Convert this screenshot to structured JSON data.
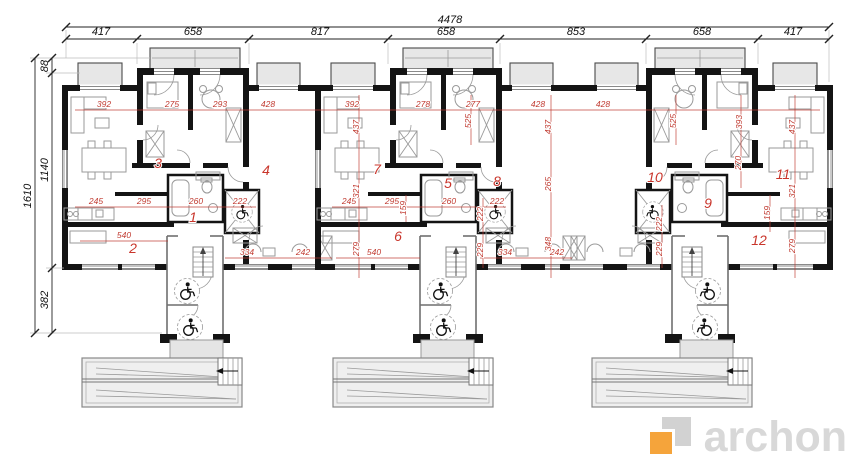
{
  "brand": {
    "name": "archon",
    "accent_color": "#F5A43B",
    "text_color": "#D8D8D8"
  },
  "colors": {
    "dimension_red": "#C03A30",
    "wall": "#141414",
    "fill_gray": "#E7E7E7"
  },
  "dimension_chains": {
    "top": {
      "total": "4478",
      "segments": [
        "417",
        "658",
        "817",
        "658",
        "853",
        "658",
        "417"
      ]
    },
    "left": {
      "total": "1610",
      "segments": [
        "88",
        "1140",
        "382"
      ]
    }
  },
  "unit_numbers": [
    "1",
    "2",
    "3",
    "4",
    "5",
    "6",
    "7",
    "8",
    "9",
    "10",
    "11",
    "12"
  ],
  "room_dimensions": {
    "horizontal": [
      "392",
      "275",
      "293",
      "428",
      "392",
      "278",
      "277",
      "428",
      "428",
      "245",
      "295",
      "260",
      "222",
      "245",
      "295",
      "260",
      "222",
      "540",
      "334",
      "242",
      "540",
      "334",
      "242"
    ],
    "vertical": [
      "437",
      "525",
      "437",
      "525",
      "393",
      "437",
      "265",
      "321",
      "321",
      "270",
      "159",
      "159",
      "222",
      "222",
      "279",
      "279",
      "348",
      "229",
      "229"
    ]
  },
  "icons": {
    "wheelchair": "wheelchair-accessible-icon"
  }
}
